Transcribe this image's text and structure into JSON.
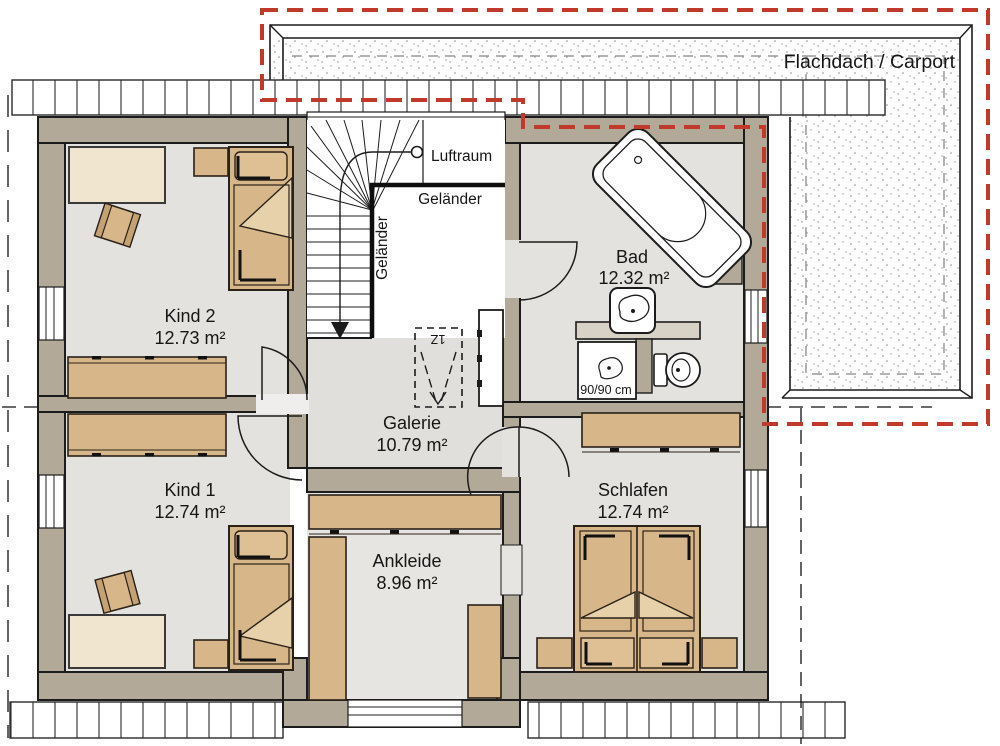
{
  "plan": {
    "type": "floor-plan",
    "rooms": {
      "kind2": {
        "label": "Kind 2",
        "area": "12.73 m²"
      },
      "kind1": {
        "label": "Kind 1",
        "area": "12.74 m²"
      },
      "galerie": {
        "label": "Galerie",
        "area": "10.79 m²"
      },
      "ankleide": {
        "label": "Ankleide",
        "area": "8.96 m²"
      },
      "schlafen": {
        "label": "Schlafen",
        "area": "12.74 m²"
      },
      "bad": {
        "label": "Bad",
        "area": "12.32 m²"
      }
    },
    "labels": {
      "carport": "Flachdach / Carport",
      "luftraum": "Luftraum",
      "gelaender_top": "Geländer",
      "gelaender_side": "Geländer",
      "shower_size": "90/90 cm",
      "chimney_flue": "1Z"
    },
    "colors": {
      "wall": "#b2a999",
      "floor": "#e4e2de",
      "furniture": "#d7b68a",
      "furniture_light": "#e3cba3",
      "desk": "#f0e6d0",
      "outline": "#1c1c1c",
      "carport_red_dashed": "#c0392b",
      "hidden_gray_dashed": "#9a9a9a"
    }
  }
}
